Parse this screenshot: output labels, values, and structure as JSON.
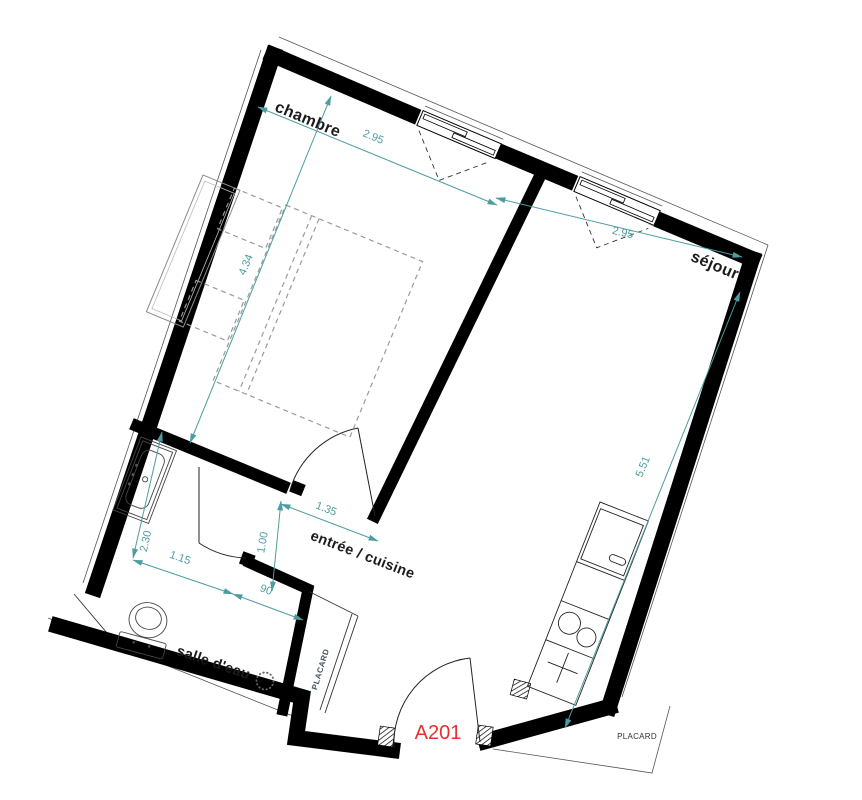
{
  "plan": {
    "unit": {
      "label": "A201"
    },
    "rooms": {
      "chambre": "chambre",
      "sejour": "séjour",
      "entree_cuisine": "entrée / cuisine",
      "salle_eau": "salle d'eau",
      "placard": "PLACARD",
      "placard_exterieur": "PLACARD"
    },
    "dims": {
      "chambre_largeur": "2.95",
      "chambre_longueur": "4.34",
      "sejour_largeur": "2.95",
      "sejour_longueur": "5.51",
      "entree_largeur": "1.35",
      "entree_profondeur": "1.00",
      "salle_eau_longueur": "2.30",
      "salle_eau_largeur": "1.15",
      "douche_largeur": "90"
    },
    "colors": {
      "dimension": "#4d9da0",
      "wall": "#000000",
      "unit_label": "#e8302e",
      "furniture": "#9a9a9a",
      "closet_label": "#3f545c"
    }
  }
}
